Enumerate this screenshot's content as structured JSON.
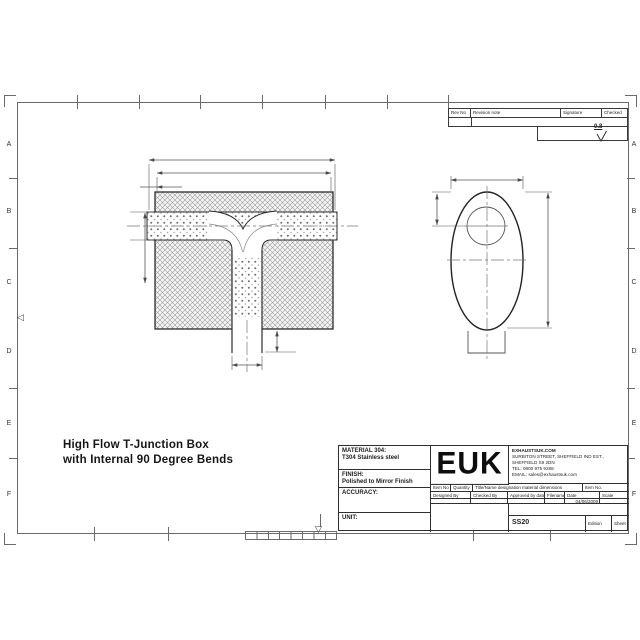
{
  "sheet": {
    "row_labels": [
      "A",
      "B",
      "C",
      "D",
      "E",
      "F"
    ],
    "center_mark_left": "◁",
    "center_mark_bottom": "▽"
  },
  "drawing_title": {
    "line1": "High Flow T-Junction Box",
    "line2": "with Internal 90 Degree Bends"
  },
  "revision_table": {
    "rev_no": "Rev No",
    "revision_note": "Revision note",
    "signature": "Signature",
    "checked": "Checked"
  },
  "surface_finish": {
    "value": "0.8"
  },
  "title_block": {
    "material_label": "MATERIAL 304:",
    "material_value": "T304 Stainless steel",
    "finish_label": "FINISH:",
    "finish_value": "Polished to Mirror Finish",
    "accuracy_label": "ACCURACY:",
    "unit_label": "UNIT:",
    "logo": "EUK",
    "company": {
      "line1": "EXHAUSTSUK.COM",
      "line2": "SURBITON STREET, SHEFFIELD IND EST.,",
      "line3": "SHEFFIELD S9 2DN",
      "line4": "TEL: 0800 975 9288",
      "line5": "EMAIL: sales@exhaustsuk.com"
    },
    "item_row": {
      "item_no": "Item No",
      "quantity": "Quantity",
      "designation": "Title/Name designation material dimensions",
      "item_no2": "Item No."
    },
    "sign_row": {
      "designed_by": "Designed By",
      "checked_by": "Checked By",
      "approved_by": "Approved by date",
      "filename": "Filename",
      "date": "Date",
      "scale": "Scale"
    },
    "date_value": "04/06/2009",
    "drawing_number": "SS20",
    "edition_label": "Edition",
    "sheet_label": "Sheet"
  },
  "colors": {
    "line": "#2f2f2f",
    "dim": "#555555",
    "hatch": "#9a9a9a"
  }
}
